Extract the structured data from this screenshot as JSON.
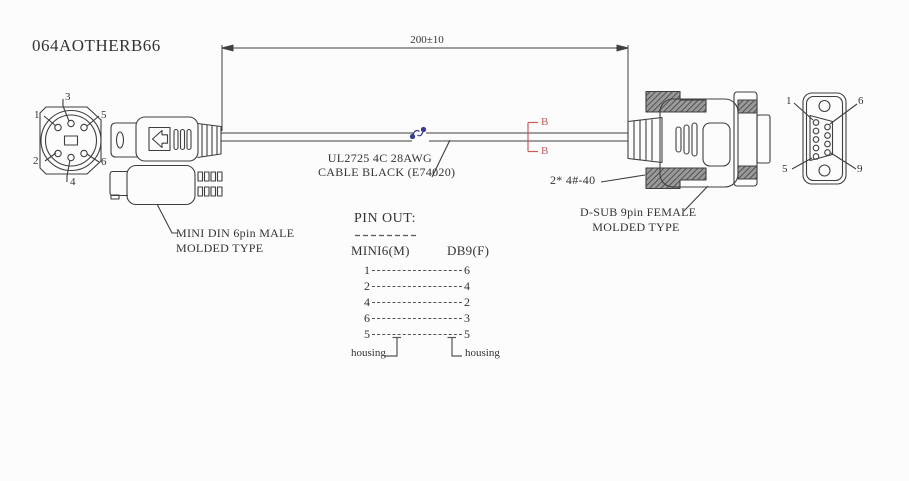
{
  "title": "064AOTHERB66",
  "dimension": {
    "length_label": "200±10"
  },
  "cable": {
    "spec_line1": "UL2725 4C 28AWG",
    "spec_line2": "CABLE BLACK (E74020)"
  },
  "section_marker": {
    "label": "B"
  },
  "minidin": {
    "caption_line1": "MINI DIN 6pin MALE",
    "caption_line2": "MOLDED TYPE",
    "front_pins": {
      "p1": "1",
      "p2": "2",
      "p3": "3",
      "p4": "4",
      "p5": "5",
      "p6": "6"
    }
  },
  "dsub": {
    "screw_label": "2* 4#-40",
    "caption_line1": "D-SUB 9pin FEMALE",
    "caption_line2": "MOLDED TYPE",
    "front_pins": {
      "p1": "1",
      "p6": "6",
      "p5": "5",
      "p9": "9"
    }
  },
  "pinout": {
    "title": "PIN OUT:",
    "col_left": "MINI6(M)",
    "col_right": "DB9(F)",
    "rows": [
      {
        "left": "1",
        "right": "6"
      },
      {
        "left": "2",
        "right": "4"
      },
      {
        "left": "4",
        "right": "2"
      },
      {
        "left": "6",
        "right": "3"
      },
      {
        "left": "5",
        "right": "5"
      }
    ],
    "housing_left": "housing",
    "housing_right": "housing"
  },
  "colors": {
    "line": "#3f3f3f",
    "section_mark": "#c85c5c",
    "cable_break": "#3b3e8f"
  }
}
